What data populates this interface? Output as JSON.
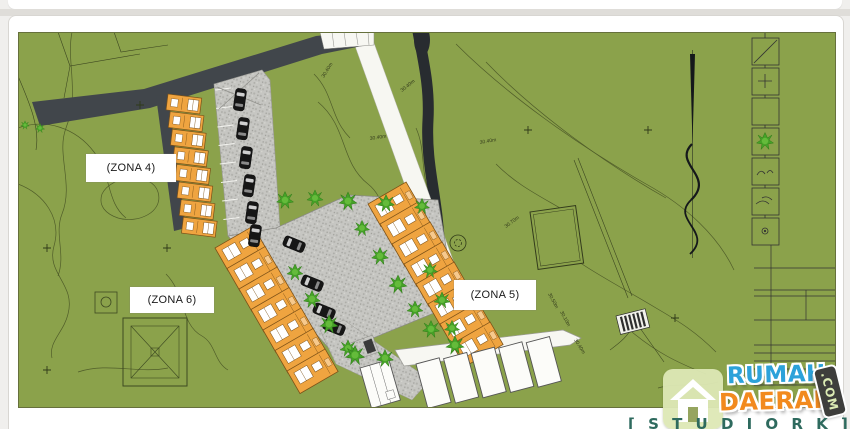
{
  "page": {
    "background": "#f0efed",
    "card_color": "#ffffff"
  },
  "plan": {
    "type": "architectural-site-plan",
    "field_color": "#8ba24b",
    "road_dark_color": "#41464b",
    "road_light_color": "#f7f7f2",
    "parking_color": "#c6c6c2",
    "house_color": "#efa440",
    "tree_color": "#45a127",
    "zone_labels": [
      {
        "text": "(ZONA 4)"
      },
      {
        "text": "(ZONA 6)"
      },
      {
        "text": "(ZONA 5)"
      }
    ],
    "zones": [
      {
        "label": "(ZONA 4)",
        "house_units": 8
      },
      {
        "label": "(ZONA 6)",
        "house_units": 7
      },
      {
        "label": "(ZONA 5)",
        "house_units": 8
      }
    ],
    "contour_labels": [
      {
        "text": "30.40m"
      },
      {
        "text": "30.40m"
      },
      {
        "text": "30.40m"
      },
      {
        "text": "30.70m"
      },
      {
        "text": "30.50m"
      },
      {
        "text": "30.10m"
      },
      {
        "text": "30.40m"
      },
      {
        "text": "30.40m"
      }
    ],
    "legend_symbols": [
      "diagonal-line",
      "cross",
      "blank",
      "tree",
      "double-arc",
      "curved-strokes",
      "small-circle"
    ]
  },
  "watermark": {
    "word1": "RUMAH",
    "word2": "DAERAH",
    "badge": ".COM",
    "word1_color": "#2ca2da",
    "word2_color": "#f28a1e",
    "badge_bg": "#3e3e3c",
    "badge_text_color": "#dcebb4",
    "tile_bg": "#dde8b5"
  },
  "footer": {
    "studio_text": "[ S T U D I O R K ]"
  }
}
